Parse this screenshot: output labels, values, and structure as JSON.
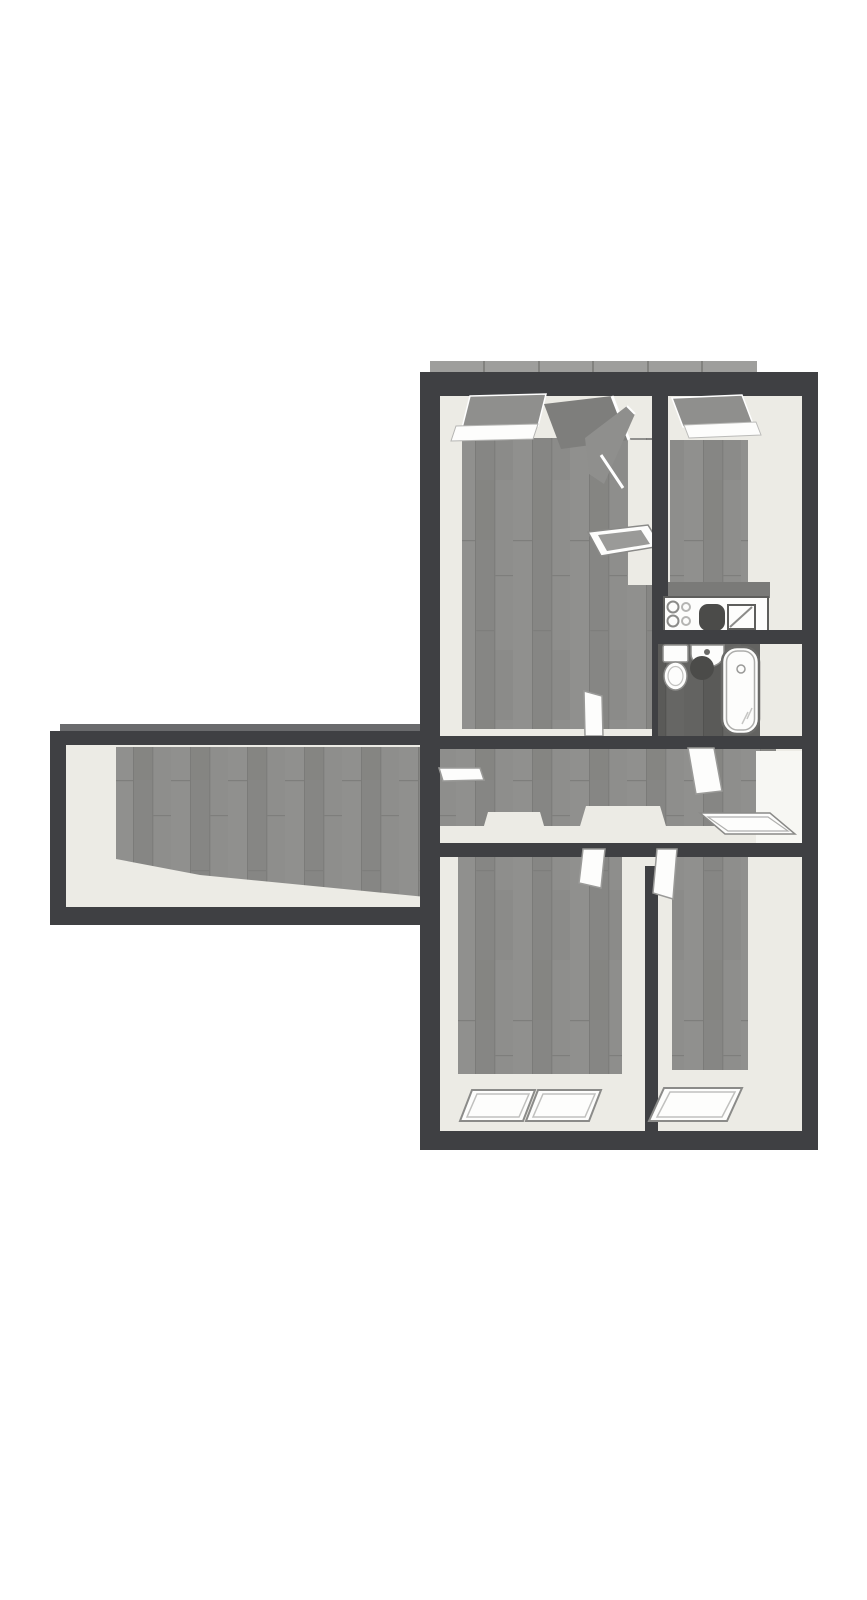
{
  "canvas": {
    "width": 867,
    "height": 1600,
    "background": "#ffffff"
  },
  "scene": {
    "kind": "3d-top-down-apartment-floor-plan",
    "text_visible": false
  },
  "colors": {
    "background": "#ffffff",
    "wall": "#3f4043",
    "floor_wood": "#8c8c8a",
    "bath_floor": "#5f5f5d",
    "interior_face": "#ecebe5",
    "interior_bright": "#f7f7f3",
    "glass": "#8f8f8d",
    "window_band": "#9e9e9c",
    "band_seam": "#82827f",
    "wing_band": "#6a6b6d",
    "fixture_fill": "#fdfdfc",
    "fixture_outline": "#8b8b89",
    "fixture_dark": "#4b4b49",
    "counter_outline": "#5e5e5c",
    "counter_shadow": "#7a7a78",
    "slab_dark": "#7e7e7c",
    "slab_mid": "#8f8f8d",
    "tray_inner": "#9a9a98"
  },
  "rooms": [
    {
      "id": "room-top-left",
      "label": "large room top-left"
    },
    {
      "id": "kitchen",
      "label": "kitchen top-right"
    },
    {
      "id": "bathroom",
      "label": "bathroom with tub, basin, toilet"
    },
    {
      "id": "hallway",
      "label": "central hallway"
    },
    {
      "id": "left-wing-room",
      "label": "long left wing room"
    },
    {
      "id": "room-bottom-left",
      "label": "room bottom-left"
    },
    {
      "id": "room-bottom-right",
      "label": "room bottom-right"
    }
  ],
  "fixtures": [
    "cooktop-burners",
    "kitchen-dark-basin",
    "kitchen-sink-square",
    "toilet",
    "wash-basin",
    "bathtub"
  ],
  "openings": {
    "top_window_band_segments": 6,
    "bottom_windows_left_room": 2,
    "bottom_windows_right_room": 1,
    "open_door_panels": 7
  }
}
